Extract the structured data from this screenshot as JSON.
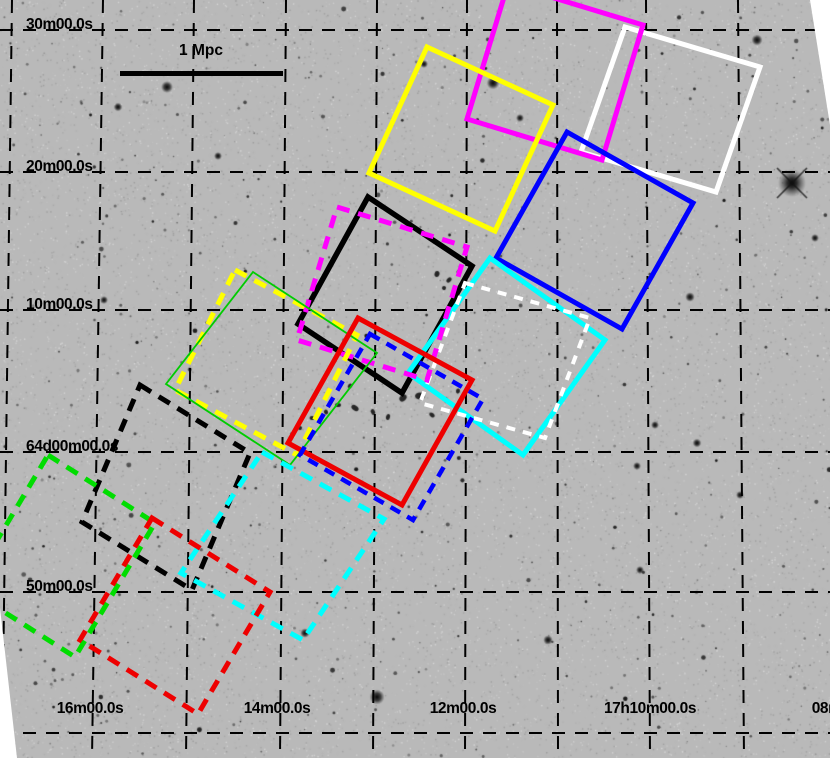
{
  "figure": {
    "kind": "sky-survey-image-with-pointing-footprints",
    "background_color": "#b9b9b9"
  },
  "scale_bar": {
    "label": "1 Mpc",
    "x1": 120,
    "x2": 283,
    "y": 73
  },
  "axes": {
    "dec_labels": [
      {
        "text": "30m00.0s",
        "x": 26,
        "y": 30
      },
      {
        "text": "20m00.0s",
        "x": 26,
        "y": 172
      },
      {
        "text": "10m00.0s",
        "x": 26,
        "y": 310
      },
      {
        "text": "64d00m00.0s",
        "x": 26,
        "y": 452
      },
      {
        "text": "50m00.0s",
        "x": 26,
        "y": 592
      }
    ],
    "ra_labels": [
      {
        "text": "16m00.0s",
        "cx": 90,
        "y": 701
      },
      {
        "text": "14m00.0s",
        "cx": 277,
        "y": 701
      },
      {
        "text": "12m00.0s",
        "cx": 463,
        "y": 701
      },
      {
        "text": "17h10m00.0s",
        "cx": 650,
        "y": 701
      },
      {
        "text": "08m00.0s",
        "cx": 845,
        "y": 701
      }
    ]
  },
  "grid": {
    "color": "#000000",
    "dash": "13 10",
    "h_lines": [
      30,
      172,
      310,
      452,
      592,
      733
    ],
    "v_lines": [
      {
        "top": 12,
        "bottom": 2
      },
      {
        "top": 103,
        "bottom": 92
      },
      {
        "top": 194,
        "bottom": 186
      },
      {
        "top": 286,
        "bottom": 280
      },
      {
        "top": 377,
        "bottom": 373
      },
      {
        "top": 467,
        "bottom": 465
      },
      {
        "top": 557,
        "bottom": 558
      },
      {
        "top": 646,
        "bottom": 650
      },
      {
        "top": 738,
        "bottom": 744
      },
      {
        "top": 830,
        "bottom": 838
      }
    ]
  },
  "plate_edges": [
    {
      "name": "bottom-left-wedge",
      "points": [
        [
          0,
          608
        ],
        [
          17,
          758
        ],
        [
          0,
          758
        ]
      ]
    },
    {
      "name": "top-right-wedge",
      "points": [
        [
          810,
          0
        ],
        [
          830,
          0
        ],
        [
          830,
          125
        ]
      ]
    }
  ],
  "pointings": [
    {
      "name": "white-solid",
      "color": "#ffffff",
      "style": "solid",
      "width": 5,
      "dash": null,
      "points": [
        [
          625,
          27
        ],
        [
          760,
          67
        ],
        [
          716,
          192
        ],
        [
          581,
          152
        ]
      ]
    },
    {
      "name": "magenta-solid",
      "color": "#ff00ff",
      "style": "solid",
      "width": 5,
      "dash": null,
      "points": [
        [
          508,
          -16
        ],
        [
          643,
          25
        ],
        [
          602,
          160
        ],
        [
          467,
          119
        ]
      ]
    },
    {
      "name": "yellow-solid",
      "color": "#ffff00",
      "style": "solid",
      "width": 5,
      "dash": null,
      "points": [
        [
          427,
          47
        ],
        [
          553,
          105
        ],
        [
          495,
          231
        ],
        [
          369,
          173
        ]
      ]
    },
    {
      "name": "blue-solid",
      "color": "#0000ff",
      "style": "solid",
      "width": 5,
      "dash": null,
      "points": [
        [
          567,
          132
        ],
        [
          693,
          203
        ],
        [
          622,
          329
        ],
        [
          496,
          258
        ]
      ]
    },
    {
      "name": "black-solid",
      "color": "#000000",
      "style": "solid",
      "width": 5.5,
      "dash": null,
      "points": [
        [
          368,
          197
        ],
        [
          472,
          266
        ],
        [
          402,
          393
        ],
        [
          298,
          324
        ]
      ]
    },
    {
      "name": "cyan-solid",
      "color": "#00ffff",
      "style": "solid",
      "width": 5,
      "dash": null,
      "points": [
        [
          490,
          258
        ],
        [
          605,
          340
        ],
        [
          523,
          455
        ],
        [
          408,
          373
        ]
      ]
    },
    {
      "name": "white-dashed",
      "color": "#ffffff",
      "style": "dashed",
      "width": 4,
      "dash": "9 8",
      "points": [
        [
          465,
          283
        ],
        [
          590,
          318
        ],
        [
          545,
          438
        ],
        [
          420,
          403
        ]
      ]
    },
    {
      "name": "magenta-dashed",
      "color": "#ff00ff",
      "style": "dashed",
      "width": 5,
      "dash": "13 9",
      "points": [
        [
          337,
          207
        ],
        [
          467,
          247
        ],
        [
          427,
          380
        ],
        [
          297,
          340
        ]
      ]
    },
    {
      "name": "yellow-dashed",
      "color": "#ffff00",
      "style": "dashed",
      "width": 5,
      "dash": "13 9",
      "points": [
        [
          235,
          270
        ],
        [
          357,
          335
        ],
        [
          297,
          455
        ],
        [
          175,
          390
        ]
      ]
    },
    {
      "name": "green-solid",
      "color": "#00cc00",
      "style": "solid",
      "width": 1.8,
      "dash": null,
      "points": [
        [
          253,
          272
        ],
        [
          377,
          353
        ],
        [
          290,
          465
        ],
        [
          166,
          384
        ]
      ]
    },
    {
      "name": "red-solid",
      "color": "#ee0000",
      "style": "solid",
      "width": 5,
      "dash": null,
      "points": [
        [
          358,
          318
        ],
        [
          472,
          380
        ],
        [
          402,
          505
        ],
        [
          288,
          443
        ]
      ]
    },
    {
      "name": "blue-dashed",
      "color": "#0000ff",
      "style": "dashed",
      "width": 4.5,
      "dash": "11 8",
      "points": [
        [
          370,
          334
        ],
        [
          483,
          399
        ],
        [
          413,
          520
        ],
        [
          300,
          455
        ]
      ]
    },
    {
      "name": "black-dashed",
      "color": "#000000",
      "style": "dashed",
      "width": 5,
      "dash": "13 9",
      "points": [
        [
          140,
          385
        ],
        [
          250,
          453
        ],
        [
          192,
          590
        ],
        [
          82,
          522
        ]
      ]
    },
    {
      "name": "cyan-dashed",
      "color": "#00ffff",
      "style": "dashed",
      "width": 5,
      "dash": "13 9",
      "points": [
        [
          262,
          452
        ],
        [
          384,
          519
        ],
        [
          303,
          640
        ],
        [
          181,
          573
        ]
      ]
    },
    {
      "name": "green-dashed",
      "color": "#00dd00",
      "style": "dashed",
      "width": 5,
      "dash": "13 9",
      "points": [
        [
          48,
          455
        ],
        [
          155,
          523
        ],
        [
          75,
          657
        ],
        [
          -32,
          589
        ]
      ]
    },
    {
      "name": "red-dashed",
      "color": "#ee0000",
      "style": "dashed",
      "width": 5,
      "dash": "13 9",
      "points": [
        [
          152,
          518
        ],
        [
          270,
          592
        ],
        [
          198,
          714
        ],
        [
          80,
          640
        ]
      ]
    }
  ]
}
